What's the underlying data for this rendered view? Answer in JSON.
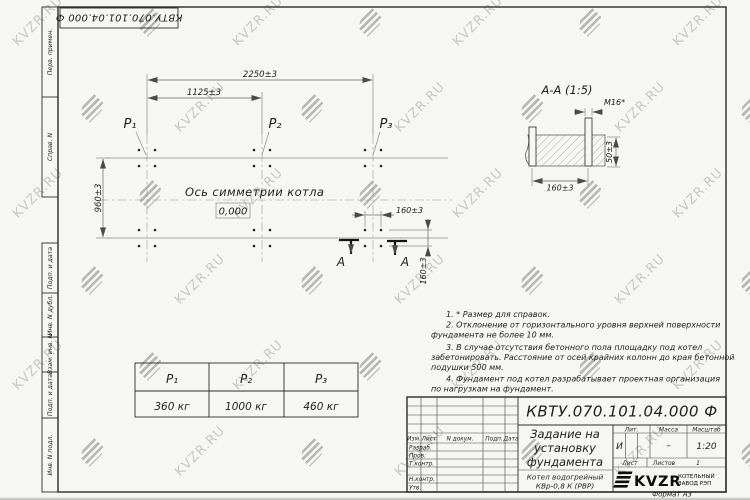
{
  "watermark": {
    "text": "KVZR.RU"
  },
  "sidebar": {
    "items": [
      "Перв. примен.",
      "Справ. N",
      "Подп. и дата",
      "Инв. N дубл.",
      "Взам. инв. N",
      "Подп. и дата",
      "Инв. N подл."
    ]
  },
  "plan": {
    "dims": {
      "width_total": "2250±3",
      "width_half": "1125±3",
      "depth": "960±3",
      "bolt_x": "160±3",
      "bolt_y": "160±3"
    },
    "labels": {
      "p1": "P₁",
      "p2": "P₂",
      "p3": "P₃",
      "axis": "Ось симметрии котла",
      "level": "0,000",
      "section": "А"
    }
  },
  "section": {
    "title": "А-А (1:5)",
    "bolt": "М16*",
    "dim_width": "160±3",
    "dim_height": "50±3"
  },
  "notes": {
    "lines": [
      "1. * Размер для справок.",
      "2. Отклонение от горизонтального уровня верхней поверхности",
      "фундамента не более 10 мм.",
      "3. В случае отсутствия бетонного пола площадку под котел",
      "забетонировать. Расстояние от осей крайних колонн до края бетонной",
      "подушки 500 мм.",
      "4. Фундамент под котел разрабатывает проектная организация",
      "по нагрузкам на фундамент."
    ]
  },
  "table": {
    "headers": [
      "P₁",
      "P₂",
      "P₃"
    ],
    "values": [
      "360 кг",
      "1000 кг",
      "460 кг"
    ]
  },
  "titleblock": {
    "doc_number": "КВТУ.070.101.04.000  Ф",
    "title_lines": [
      "Задание на",
      "установку",
      "фундамента"
    ],
    "product_lines": [
      "Котел водогрейный",
      "КВр-0,8 К (РВР)"
    ],
    "cols": {
      "izm": "Изм.",
      "list": "Лист",
      "ndoc": "N докум.",
      "podp": "Подп.",
      "data": "Дата"
    },
    "rows": [
      "Разраб.",
      "Пров.",
      "Т.контр.",
      "Н.контр.",
      "Утв."
    ],
    "lit": {
      "label": "Лит.",
      "value": "И"
    },
    "massa": {
      "label": "Масса",
      "value": "–"
    },
    "scale": {
      "label": "Масштаб",
      "value": "1:20"
    },
    "sheet": {
      "label": "Лист",
      "total_label": "Листов",
      "total_value": "1"
    },
    "logo": {
      "text": "KVZR",
      "caption_lines": [
        "КОТЕЛЬНЫЙ",
        "ЗАВОД РЭП"
      ]
    },
    "format": "Формат А3"
  }
}
